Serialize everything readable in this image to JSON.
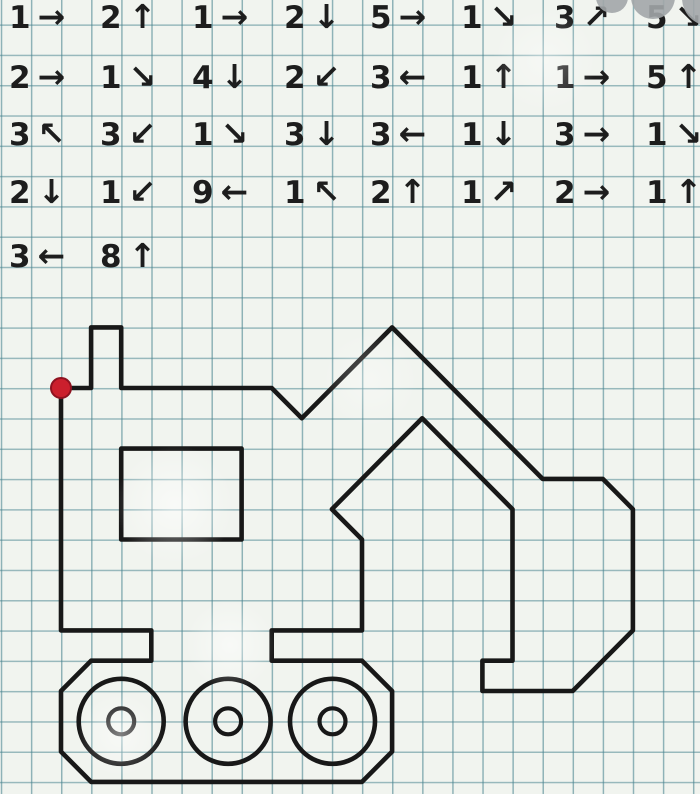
{
  "worksheet": {
    "kind": "graphical-dictation",
    "subject": "excavator"
  },
  "arrow_glyphs": {
    "right": "→",
    "left": "←",
    "up": "↑",
    "down": "↓",
    "up-left": "↖",
    "up-right": "↗",
    "down-right": "↘",
    "down-left": "↙"
  },
  "instructions": {
    "rows": [
      [
        {
          "count": 1,
          "dir": "right"
        },
        {
          "count": 2,
          "dir": "up"
        },
        {
          "count": 1,
          "dir": "right"
        },
        {
          "count": 2,
          "dir": "down"
        },
        {
          "count": 5,
          "dir": "right"
        },
        {
          "count": 1,
          "dir": "down-right"
        },
        {
          "count": 3,
          "dir": "up-right"
        },
        {
          "count": 5,
          "dir": "down-right"
        }
      ],
      [
        {
          "count": 2,
          "dir": "right"
        },
        {
          "count": 1,
          "dir": "down-right"
        },
        {
          "count": 4,
          "dir": "down"
        },
        {
          "count": 2,
          "dir": "down-left"
        },
        {
          "count": 3,
          "dir": "left"
        },
        {
          "count": 1,
          "dir": "up"
        },
        {
          "count": 1,
          "dir": "right"
        },
        {
          "count": 5,
          "dir": "up"
        }
      ],
      [
        {
          "count": 3,
          "dir": "up-left"
        },
        {
          "count": 3,
          "dir": "down-left"
        },
        {
          "count": 1,
          "dir": "down-right"
        },
        {
          "count": 3,
          "dir": "down"
        },
        {
          "count": 3,
          "dir": "left"
        },
        {
          "count": 1,
          "dir": "down"
        },
        {
          "count": 3,
          "dir": "right"
        },
        {
          "count": 1,
          "dir": "down-right"
        }
      ],
      [
        {
          "count": 2,
          "dir": "down"
        },
        {
          "count": 1,
          "dir": "down-left"
        },
        {
          "count": 9,
          "dir": "left"
        },
        {
          "count": 1,
          "dir": "up-left"
        },
        {
          "count": 2,
          "dir": "up"
        },
        {
          "count": 1,
          "dir": "up-right"
        },
        {
          "count": 2,
          "dir": "right"
        },
        {
          "count": 1,
          "dir": "up"
        }
      ],
      [
        {
          "count": 3,
          "dir": "left"
        },
        {
          "count": 8,
          "dir": "up"
        }
      ]
    ]
  },
  "drawing": {
    "window": {
      "col": 2,
      "row": 2,
      "w_cells": 4,
      "h_cells": 3
    },
    "wheels": {
      "centers_cols": [
        2.0,
        5.55,
        9.02
      ],
      "center_row": 11,
      "outer_r_px": 42.5,
      "inner_r_px": 13
    },
    "start_dot_r_px": 10
  },
  "watermark": {
    "circles": [
      {
        "cx": 612,
        "cy": -3,
        "r": 16
      },
      {
        "cx": 653,
        "cy": -3,
        "r": 22
      },
      {
        "cx": 710,
        "cy": -2,
        "r": 28
      }
    ]
  },
  "colors": {
    "ink": "#181818",
    "start_dot": "#cb1f2d",
    "start_dot_edge": "#8e1220",
    "watermark": "#a2a6a8",
    "grid_line": "#46828e",
    "paper": "#f1f4ef"
  }
}
